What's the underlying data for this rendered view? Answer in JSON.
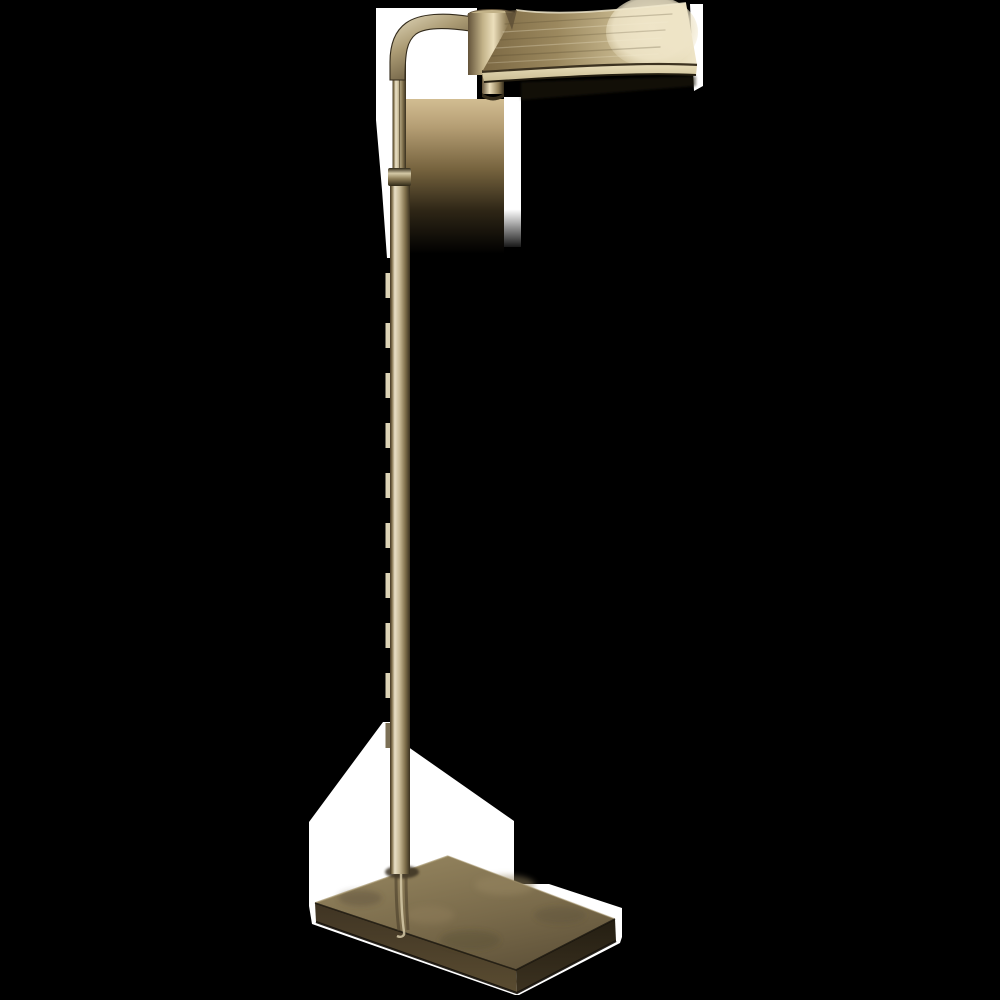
{
  "scene": {
    "kind": "product-photograph",
    "subject": "adjustable pharmacy floor lamp in antique brass",
    "background_color": "#000000",
    "photo_backdrop_color": "#ffffff"
  },
  "palette": {
    "bg": "#000000",
    "white": "#ffffff",
    "poleEdgeL": "#3e3422",
    "poleHL": "#e9e0c6",
    "poleMid": "#c7ba96",
    "poleShadow": "#84744f",
    "poleEdgeR": "#38301e",
    "tab": "#dcd3b6",
    "tabDark": "#6e6144",
    "jointDark": "#2f2817",
    "jointLight": "#d5c9a6",
    "jointMid": "#8d7d57",
    "armHL": "#e5dcc0",
    "armBody": "#ab9b74",
    "armShadow": "#5c4e35",
    "armOutline": "#332b1c",
    "hubDark": "#63533a",
    "hubMid": "#c2b288",
    "hubHL": "#ecdfbc",
    "hubRight": "#917f58",
    "hubRimDark": "#352c1b",
    "shadeDark": "#7b6843",
    "shadeMid": "#9b885e",
    "shadeLight": "#c2b289",
    "shadePale": "#ddd1ab",
    "shadeBell": "#efe5c8",
    "shadeRim": "#f0e8cc",
    "creaseDark": "#3c3220",
    "lipLight": "#e8dcb8",
    "lipMid": "#c9bc92",
    "lipEdge": "#241e11",
    "streakLight": "#f4ecd2",
    "streakDark": "#4e4228",
    "tanTop": "#d2bd92",
    "tanUpper": "#b59e74",
    "tanMid": "#77643f",
    "tanDark": "#2e2616",
    "baseTopLight": "#95855f",
    "baseTopMid": "#7a6b4b",
    "baseTopDark": "#5f5239",
    "baseFrontL1": "#3f3423",
    "baseFrontL2": "#5a4c31",
    "baseFrontR1": "#241e12",
    "baseFrontR2": "#3c3220",
    "baseRim": "#a5956d",
    "baseEdgeDark": "#15110a",
    "reflLight": "#d6caa8",
    "reflDark": "#4a3e2a",
    "footShadow": "#3a3020",
    "mottle": "#4f4430"
  }
}
